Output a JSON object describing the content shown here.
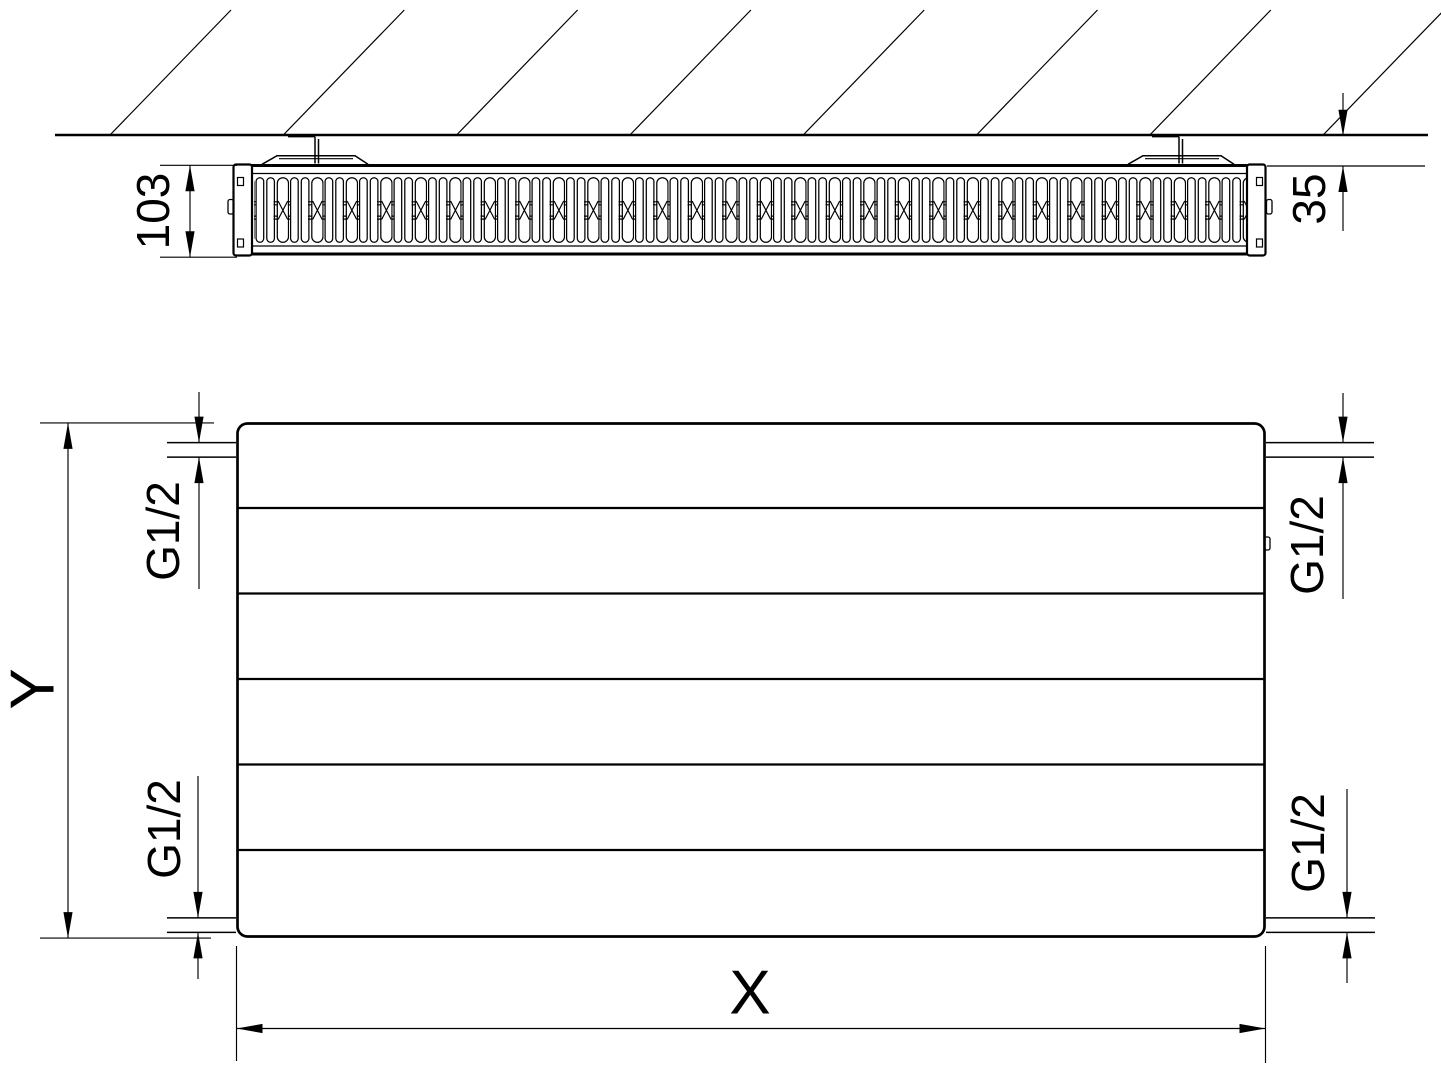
{
  "drawing": {
    "labels": {
      "depth": "103",
      "wall_clearance": "35",
      "width": "X",
      "height": "Y",
      "connections": {
        "top_left": "G1/2",
        "top_right": "G1/2",
        "bottom_left": "G1/2",
        "bottom_right": "G1/2"
      }
    },
    "colors": {
      "line": "#000000",
      "background": "#ffffff"
    }
  }
}
